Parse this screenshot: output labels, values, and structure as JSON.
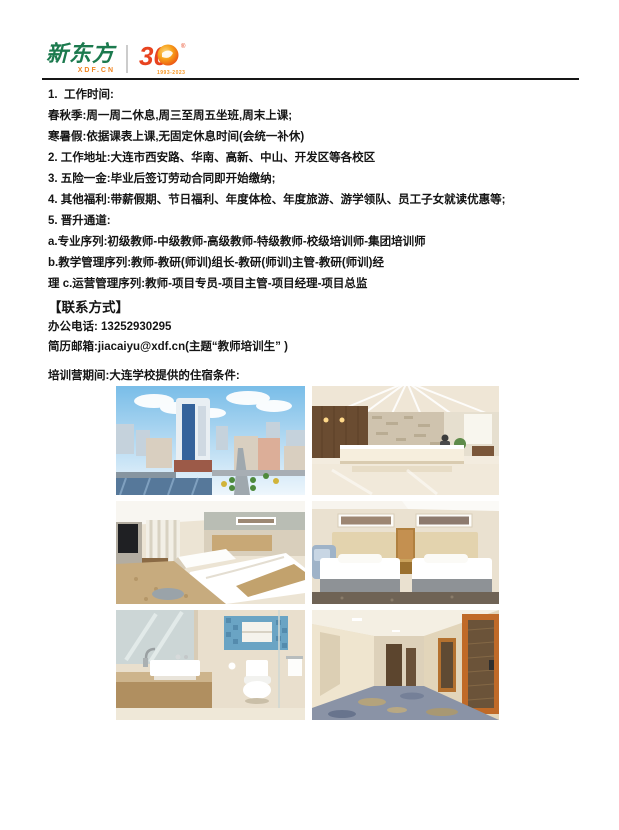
{
  "header": {
    "brand": {
      "name": "新东方",
      "domain": "XDF.CN",
      "anniversary": "30",
      "years": "1993-2023",
      "reg": "®"
    },
    "colors": {
      "brand_green": "#1c7a4e",
      "brand_orange": "#ef8420",
      "anniversary_red": "#e8431f",
      "anniversary_orange": "#f7a21b"
    }
  },
  "body": {
    "lines": [
      "1.  工作时间:",
      "春秋季:周一周二休息,周三至周五坐班,周末上课;",
      "寒暑假:依据课表上课,无固定休息时间(会统一补休)",
      "2. 工作地址:大连市西安路、华南、高新、中山、开发区等各校区",
      "3. 五险一金:毕业后签订劳动合同即开始缴纳;",
      "4. 其他福利:带薪假期、节日福利、年度体检、年度旅游、游学领队、员工子女就读优惠等;",
      "5. 晋升通道:",
      "a.专业序列:初级教师-中级教师-高级教师-特级教师-校级培训师-集团培训师",
      "b.教学管理序列:教师-教研(师训)组长-教研(师训)主管-教研(师训)经",
      "理 c.运营管理序列:教师-项目专员-项目主管-项目经理-项目总监"
    ]
  },
  "contact": {
    "heading": "【联系方式】",
    "phone": "办公电话: 13252930295",
    "email": "简历邮箱:jiacaiyu@xdf.cn(主题“教师培训生” )"
  },
  "accommodation": {
    "intro": "培训营期间:大连学校提供的住宿条件:",
    "photos": [
      {
        "name": "city-building-aerial-photo"
      },
      {
        "name": "hotel-lobby-reception-photo"
      },
      {
        "name": "twin-bedroom-angled-photo"
      },
      {
        "name": "twin-bedroom-front-photo"
      },
      {
        "name": "bathroom-photo"
      },
      {
        "name": "hotel-corridor-photo"
      }
    ]
  }
}
